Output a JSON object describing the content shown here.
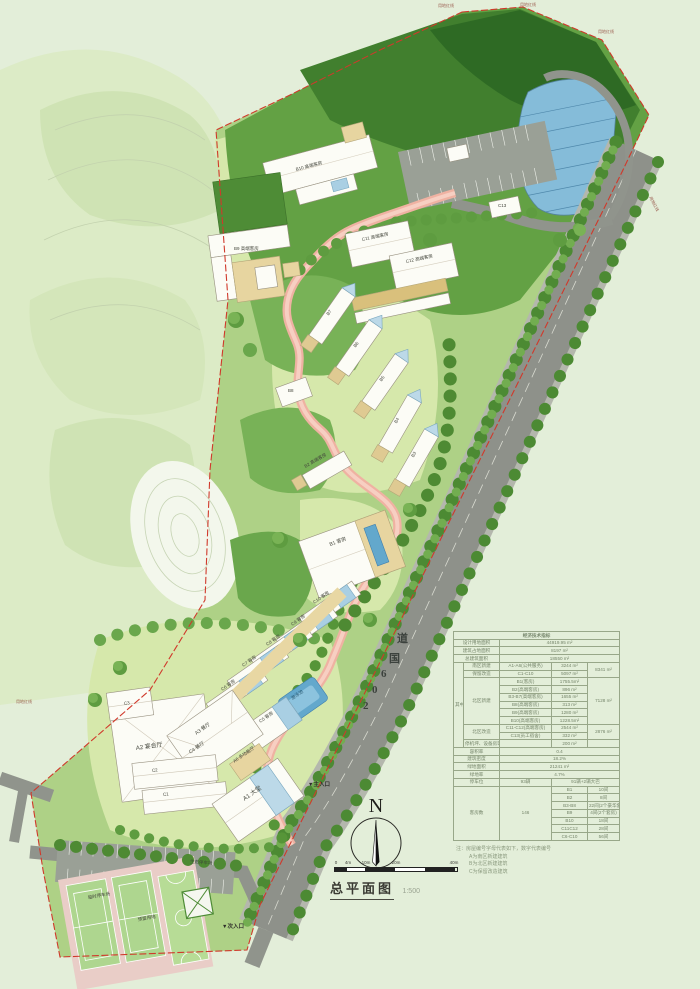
{
  "meta": {
    "drawing_title": "总平面图",
    "drawing_scale": "1:500"
  },
  "compass": {
    "north": "N"
  },
  "scalebar": {
    "t0": "0",
    "t1": "4m",
    "t2": "10m",
    "t3": "20m",
    "t4": "40m"
  },
  "road": {
    "c0": "2",
    "c1": "0",
    "c2": "6",
    "c3": "国",
    "c4": "道"
  },
  "entrances": {
    "main": "▼主入口",
    "secondary": "▼次入口"
  },
  "boundary": {
    "label": "用地红线"
  },
  "site_labels": {
    "pool": "游泳池",
    "eco_parking": "生态停车场",
    "temp_parking": "临时停车场",
    "reserved": "预留用地"
  },
  "buildings": {
    "b10": "B10 高端客房",
    "b9": "B9 高端客房",
    "c11": "C11 高端客房",
    "c12": "C12 高端客房",
    "c13": "C13",
    "b8": "B8",
    "b7": "B7",
    "b6": "B6",
    "b5": "B5",
    "b4": "B4",
    "b3": "B3",
    "b2": "B2 高端客房",
    "b1": "B1 客房",
    "c10": "C10 客房",
    "c9": "C9 客房",
    "c8": "C8 客房",
    "c7": "C7 客房",
    "c6": "C6 客房",
    "c5": "C5 客房",
    "a3": "A3 餐厅",
    "c4": "C4 餐厅",
    "a6": "A6 多功能厅",
    "a2": "A2 宴会厅",
    "c3": "C3",
    "c2": "C2",
    "c1": "C1",
    "a1": "A1 大堂"
  },
  "notes": {
    "l0": "注：房屋编号字母代表如下，数字代表编号",
    "l1": "A为南区新建建筑",
    "l2": "B为北区新建建筑",
    "l3": "C为保留改造建筑"
  },
  "table": {
    "title": "经济技术指标",
    "land_label": "设计用地面积",
    "land_value": "44919.95 m²",
    "footprint_label": "建筑占地面积",
    "footprint_value": "8197  m²",
    "gfa_label": "总建筑面积",
    "gfa_value": "18550  m²",
    "among_label": "其中",
    "south_new_label": "南区新建",
    "south_new_item": "A1-A6(公共服务)",
    "south_new_value": "3244 m²",
    "retain_label": "保留改造",
    "retain_item": "C1-C10",
    "retain_value": "5097 m²",
    "south_subtotal": "8341 m²",
    "north_new_label": "北区新建",
    "b1_item": "B1(客房)",
    "b1_value": "1755.5m²",
    "b2_item": "B2(高端客房)",
    "b2_value": "896  m²",
    "b37_item": "B3-B7(高端客房)",
    "b37_value": "1655  m²",
    "b8_item": "B8(高端客房)",
    "b8_value": "313  m²",
    "b9_item": "B9(高端客房)",
    "b9_value": "1280  m²",
    "b10_item": "B10(高端客房)",
    "b10_value": "1228.5m²",
    "north_subtotal": "7128 m²",
    "north_retain_label": "北区改造",
    "c1112_item": "C11-C12(高端客房)",
    "c1112_value": "2544 m²",
    "c13_item": "C13(员工宿舍)",
    "c13_value": "332  m²",
    "north_retain_subtotal": "2876 m²",
    "heli_label": "停机坪、设备房等",
    "heli_value": "200  m²",
    "far_label": "容积率",
    "far_value": "0.4",
    "density_label": "建筑密度",
    "density_value": "18.2%",
    "green_area_label": "绿地面积",
    "green_area_value": "21241  m²",
    "green_rate_label": "绿地率",
    "green_rate_value": "4.7%",
    "parking_label": "停车位",
    "parking_value": "93辆",
    "parking_note": "91辆+2辆大巴",
    "rooms_label": "客房数",
    "rooms_value": "146",
    "rooms": [
      {
        "id": "B1",
        "count": "10间"
      },
      {
        "id": "B2",
        "count": "8间"
      },
      {
        "id": "B3-B8",
        "count": "22间(2个豪华套间)"
      },
      {
        "id": "B9",
        "count": "4间(2个套房)"
      },
      {
        "id": "B10",
        "count": "18间"
      },
      {
        "id": "C11C12",
        "count": "28间"
      },
      {
        "id": "C6-C10",
        "count": "56间"
      }
    ]
  }
}
